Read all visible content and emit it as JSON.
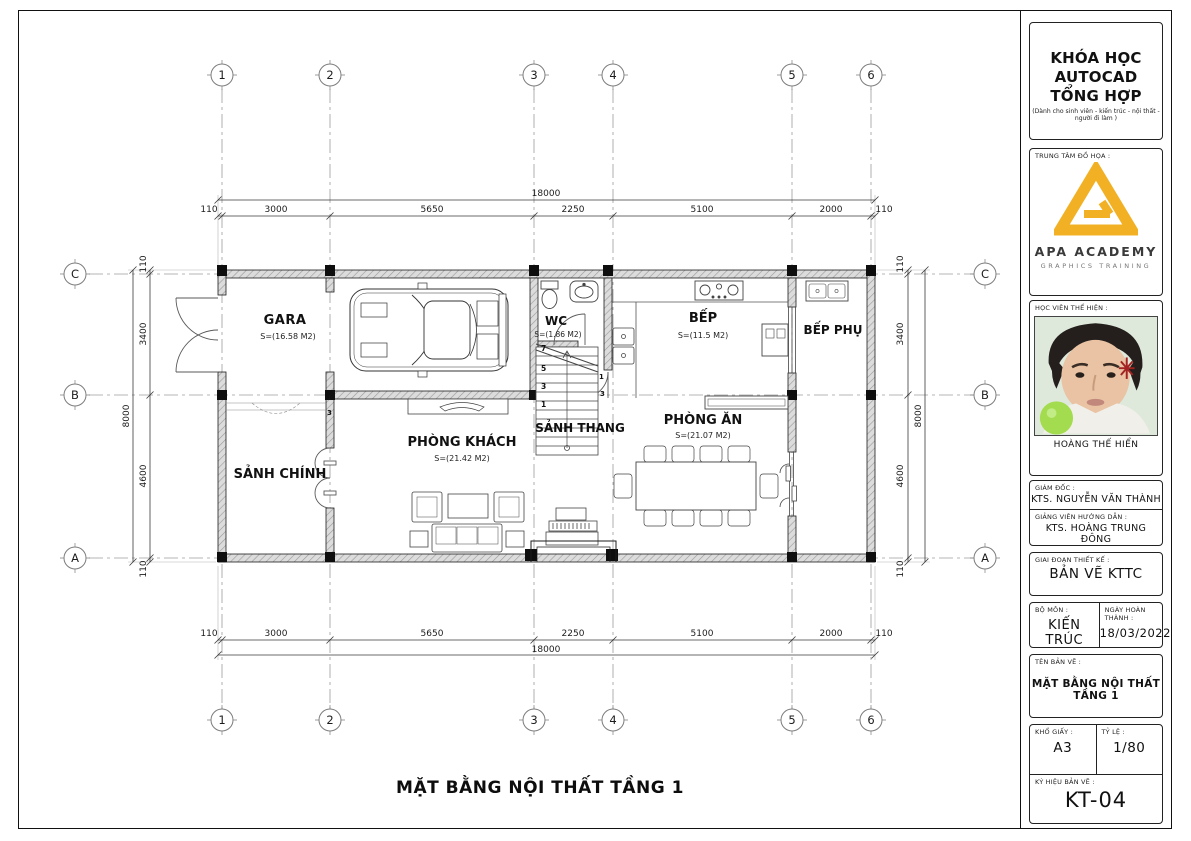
{
  "sheet": {
    "title_bottom": "MẶT BẰNG NỘI THẤT TẦNG 1"
  },
  "plan": {
    "grid_columns": [
      "1",
      "2",
      "3",
      "4",
      "5",
      "6"
    ],
    "grid_rows": [
      "C",
      "B",
      "A"
    ],
    "dim_total_h": "18000",
    "dim_total_v": "8000",
    "dims_h": [
      "110",
      "3000",
      "5650",
      "2250",
      "5100",
      "2000",
      "110"
    ],
    "dims_v": [
      "110",
      "3400",
      "4600",
      "110"
    ],
    "rooms": {
      "gara": {
        "name": "GARA",
        "area": "S=(16.58 M2)"
      },
      "wc": {
        "name": "WC",
        "area": "S=(1.86 M2)"
      },
      "bep": {
        "name": "BẾP",
        "area": "S=(11.5 M2)"
      },
      "bep_phu": {
        "name": "BẾP PHỤ"
      },
      "sanh_chinh": {
        "name": "SẢNH CHÍNH"
      },
      "phong_khach": {
        "name": "PHÒNG KHÁCH",
        "area": "S=(21.42 M2)"
      },
      "sanh_thang": {
        "name": "SẢNH THANG"
      },
      "phong_an": {
        "name": "PHÒNG ĂN",
        "area": "S=(21.07 M2)"
      }
    },
    "stair_numbers": [
      "7",
      "5",
      "3",
      "1"
    ],
    "step_numbers": [
      "1",
      "3"
    ]
  },
  "titleblock": {
    "course_line1": "KHÓA HỌC",
    "course_line2": "AUTOCAD TỔNG HỢP",
    "course_subtitle": "(Dành cho sinh viên - kiến trúc - nội thất - người đi làm )",
    "center_label": "TRUNG TÂM ĐỒ HỌA :",
    "academy_name": "APA ACADEMY",
    "academy_tagline": "GRAPHICS TRAINING",
    "student_label": "HỌC VIÊN THỂ HIỆN :",
    "student_name": "HOÀNG THẾ HIỂN",
    "director_label": "GIÁM ĐỐC :",
    "director_name": "KTS. NGUYỄN VĂN THÀNH",
    "instructor_label": "GIẢNG VIÊN HƯỚNG DẪN :",
    "instructor_name": "KTS. HOÀNG TRUNG ĐÔNG",
    "phase_label": "GIAI ĐOẠN THIẾT KẾ :",
    "phase_value": "BẢN VẼ KTTC",
    "dept_label": "BỘ MÔN :",
    "dept_value": "KIẾN TRÚC",
    "date_label": "NGÀY HOÀN THÀNH :",
    "date_value": "18/03/2022",
    "name_label": "TÊN BẢN VẼ :",
    "name_value": "MẶT BẰNG NỘI THẤT TẦNG 1",
    "paper_label": "KHỔ GIẤY :",
    "paper_value": "A3",
    "scale_label": "TỶ LỆ :",
    "scale_value": "1/80",
    "code_label": "KÝ HIỆU BẢN VẼ :",
    "code_value": "KT-04"
  },
  "colors": {
    "accent": "#F2B124",
    "wall_fill": "#dcdcdc",
    "line": "#1c1c1c"
  }
}
